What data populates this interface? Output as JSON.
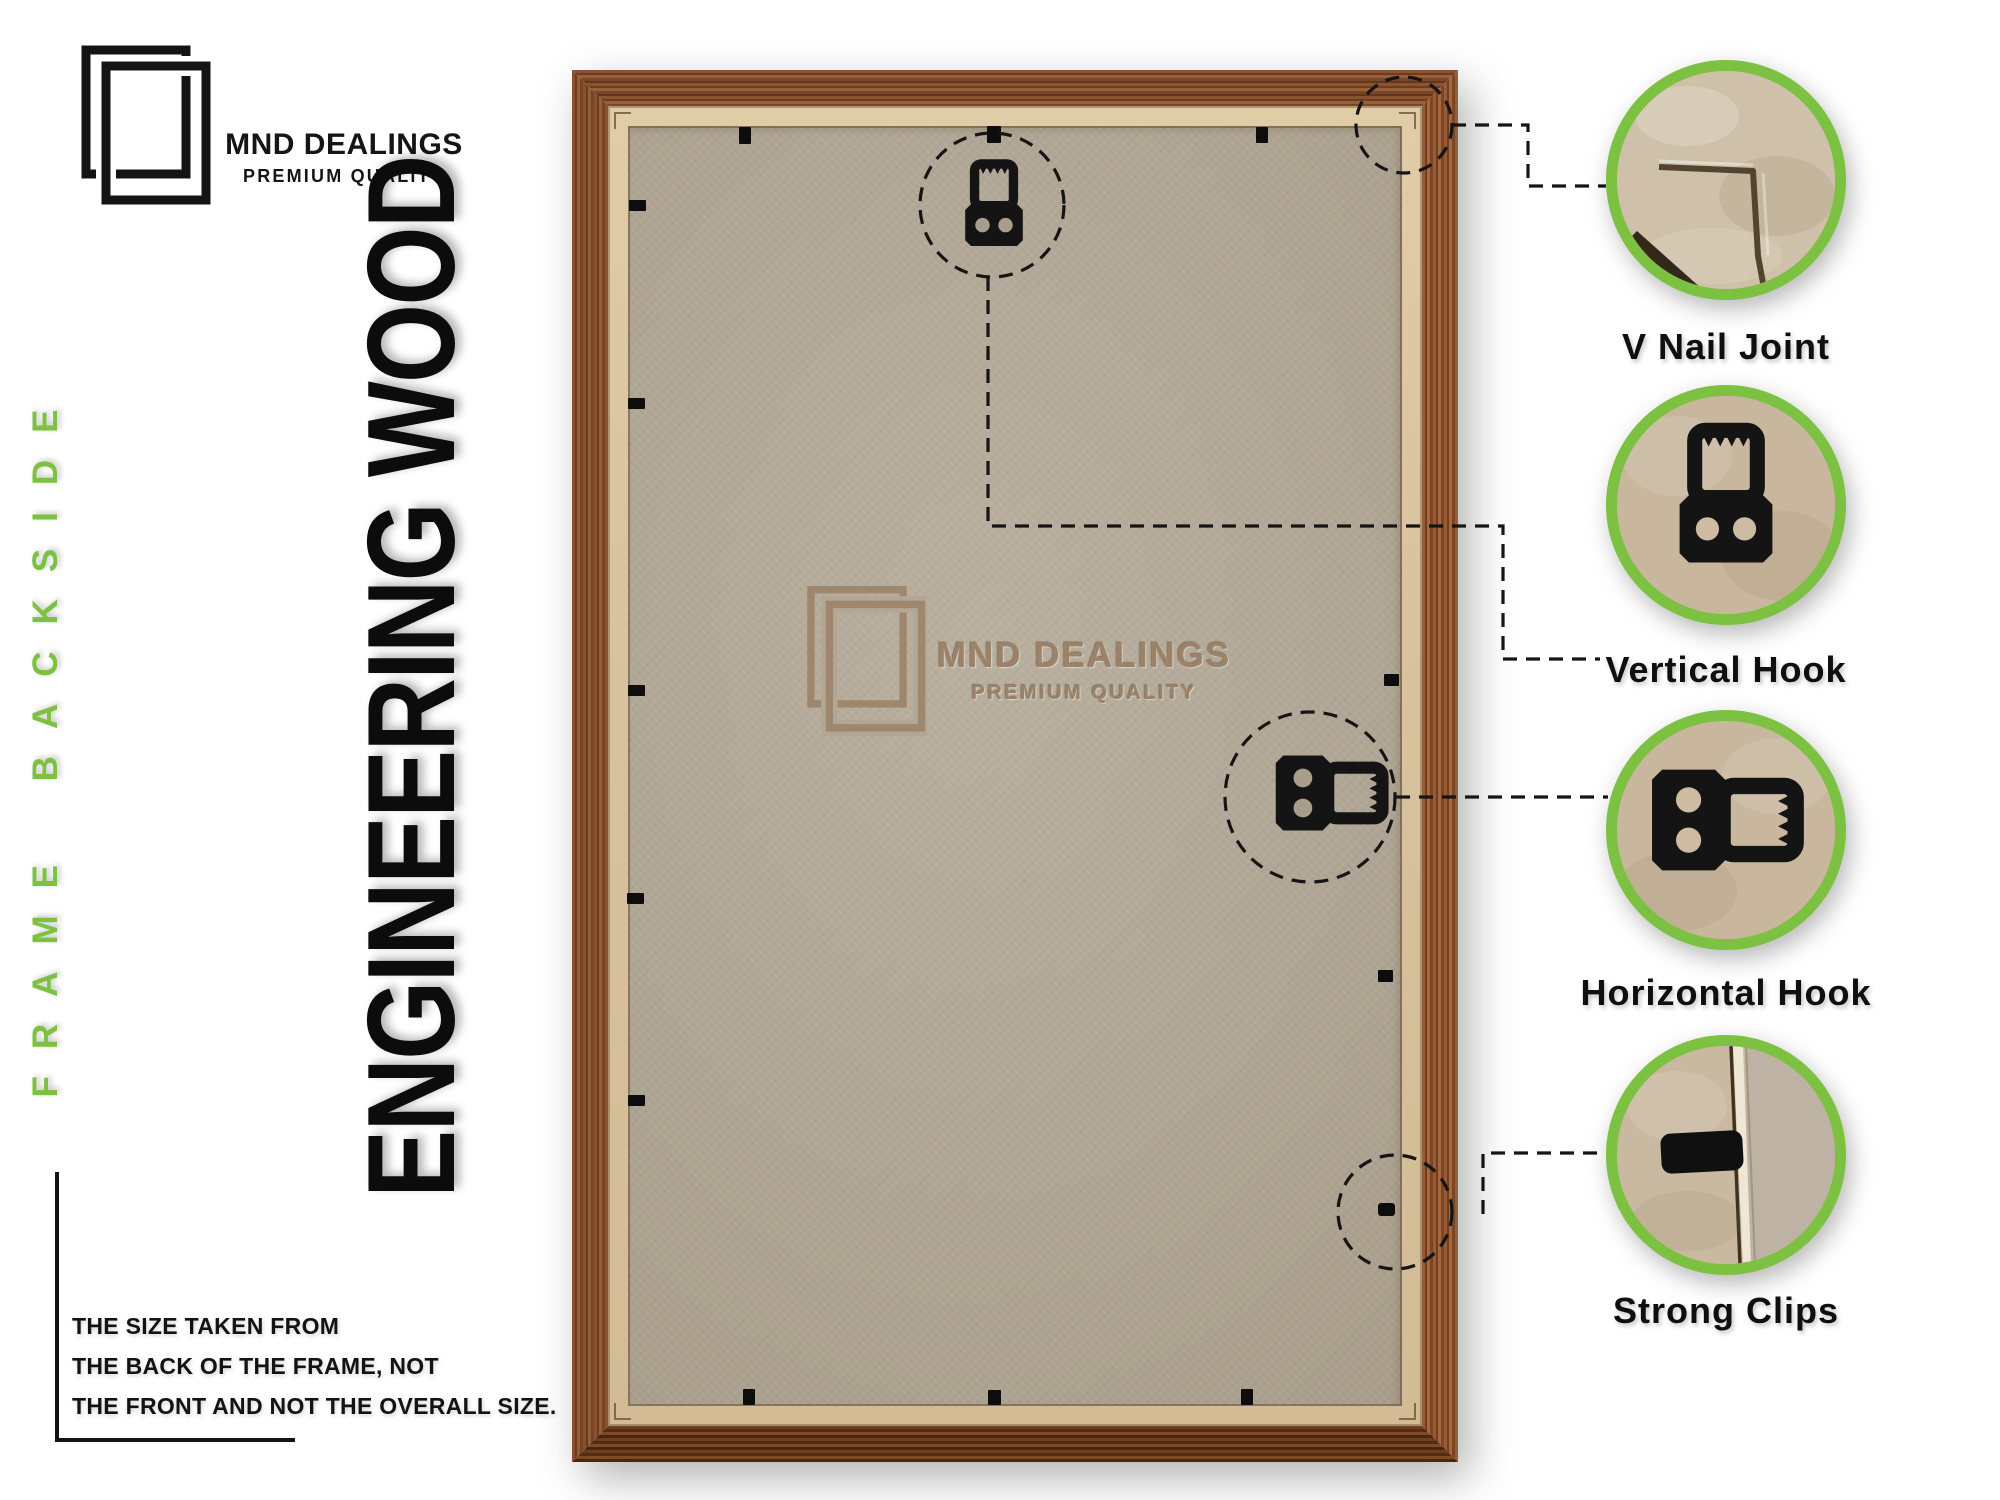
{
  "brand": {
    "name": "MND DEALINGS",
    "tagline": "PREMIUM QUALITY"
  },
  "side_label": "FRAME BACKSIDE",
  "material_label": "ENGINEERING WOOD",
  "watermark": {
    "name": "MND DEALINGS",
    "tagline": "PREMIUM QUALITY"
  },
  "note_lines": [
    "THE SIZE TAKEN FROM",
    "THE BACK OF THE FRAME, NOT",
    "THE FRONT AND NOT THE OVERALL SIZE."
  ],
  "callouts": [
    {
      "id": "v-nail-joint",
      "label": "V Nail Joint"
    },
    {
      "id": "vertical-hook",
      "label": "Vertical Hook"
    },
    {
      "id": "horizontal-hook",
      "label": "Horizontal Hook"
    },
    {
      "id": "strong-clips",
      "label": "Strong Clips"
    }
  ],
  "colors": {
    "accent_green": "#7cc142",
    "wood_brown": "#7a4726",
    "inner_strip_tan": "#d8c29d",
    "board_tan": "#b2a795",
    "watermark_brown": "#9c8368",
    "label_black": "#0f0f0f"
  }
}
